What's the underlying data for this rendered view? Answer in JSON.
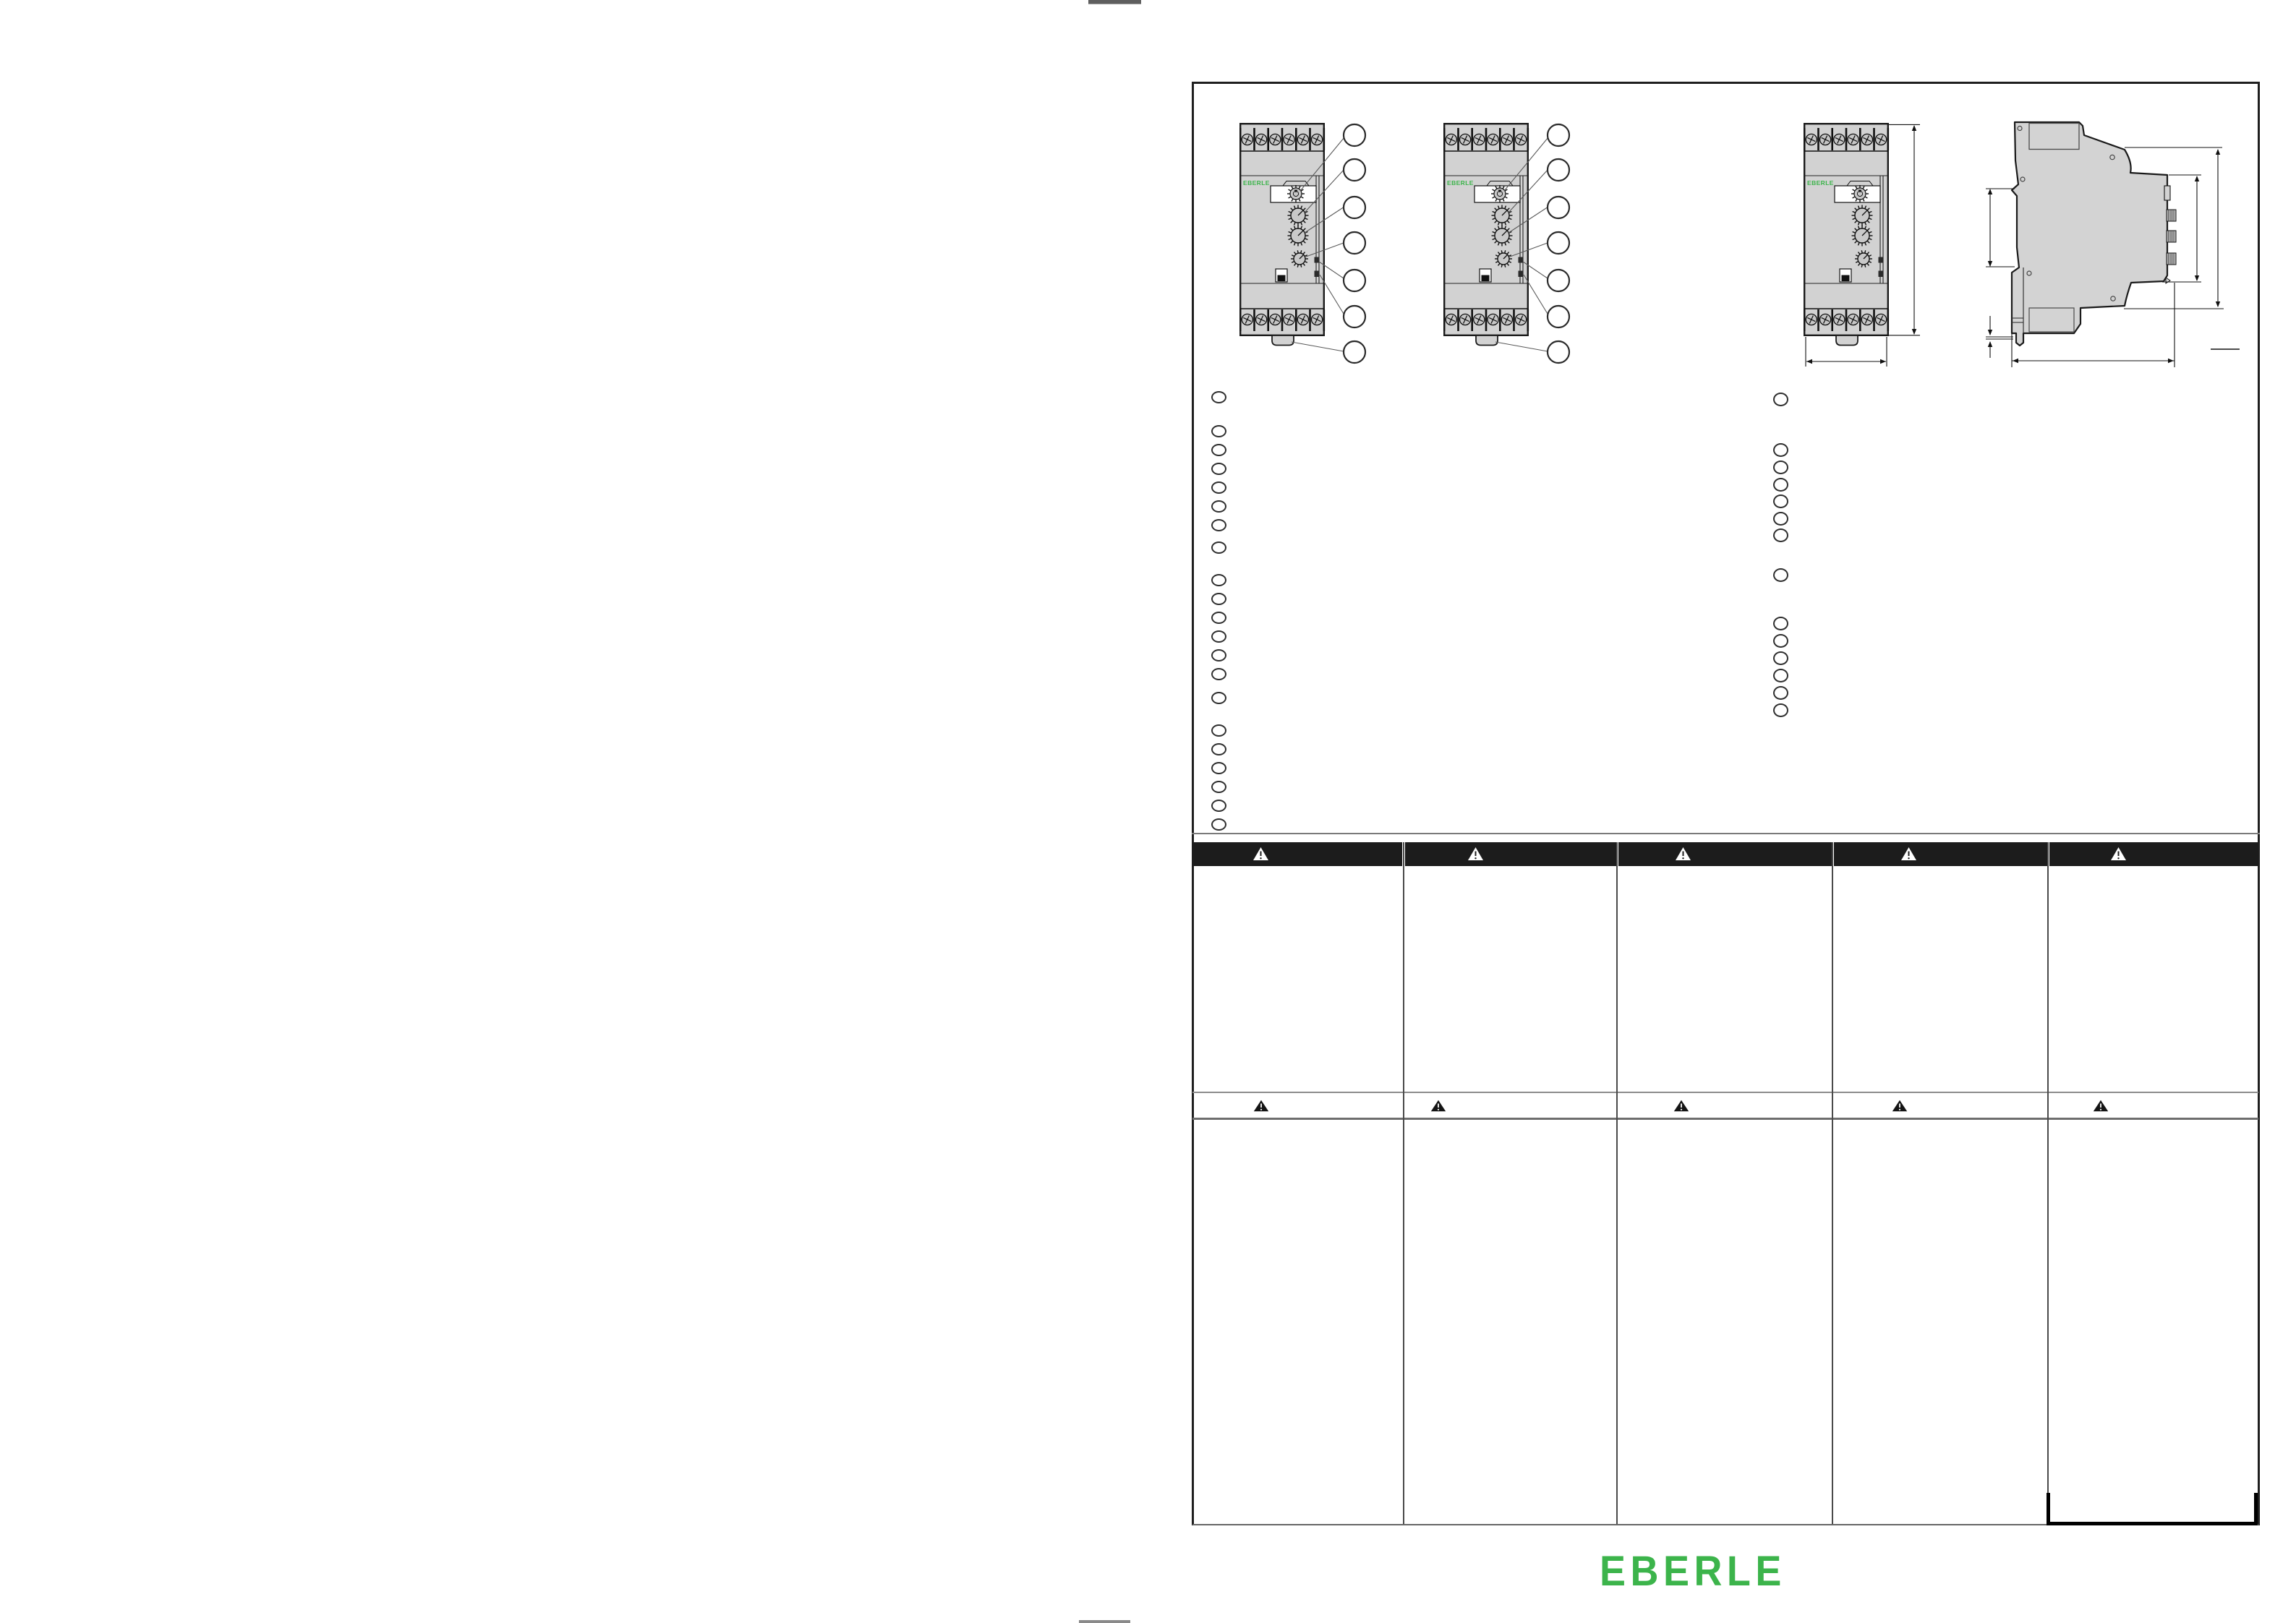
{
  "page": {
    "background_color": "#ffffff",
    "brand_color": "#3cb44b",
    "logo_text": "EBERLE"
  },
  "device": {
    "label": "EBERLE",
    "front_view_count": 3,
    "has_side_view": true,
    "terminal_screws_per_block": 6,
    "callouts_per_device": 7
  },
  "legend": {
    "left_column_groups": [
      1,
      6,
      1,
      6,
      1,
      6
    ],
    "right_column_groups": [
      1,
      6,
      1,
      6
    ]
  },
  "warning": {
    "symbol": "!",
    "header_triangles": 5,
    "row_triangles": 5
  },
  "table": {
    "column_count": 5,
    "header_color": "#1c1c1c"
  }
}
